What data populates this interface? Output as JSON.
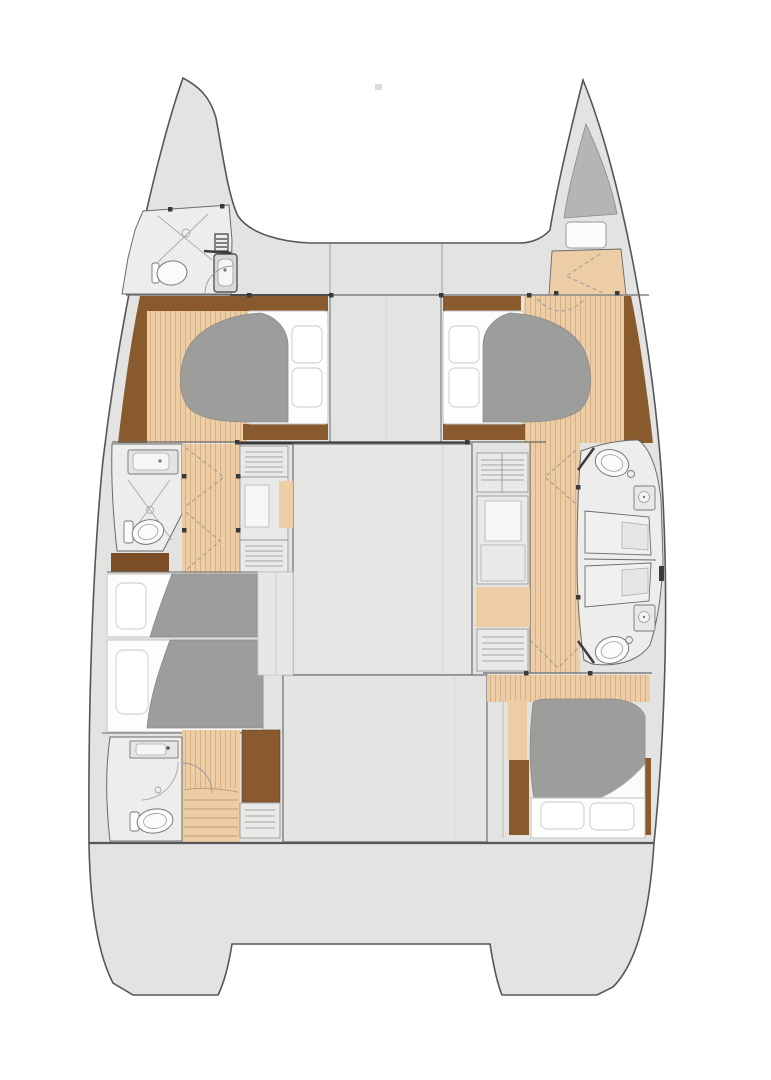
{
  "figure": {
    "type": "floorplan",
    "subject": "catamaran-interior-layout",
    "orientation": "bow-up",
    "hulls": 2,
    "visible_features": {
      "double_berth_cabins": 3,
      "single_berth_cabins": 2,
      "bathrooms": 4,
      "shower_stalls": 2,
      "bow_berth": 1,
      "transoms": 2
    }
  },
  "palette": {
    "background": "#ffffff",
    "deck": "#e3e3e2",
    "deck_line": "#55565a",
    "wall": "#6a6a6b",
    "dark": "#3a3a3b",
    "room": "#ededec",
    "cabinet": "#e9e9e8",
    "cabinet_line": "#8f8f90",
    "inset": "#f6f6f5",
    "wood": "#eccda5",
    "wood_line": "#d7b184",
    "wood_dark": "#8a5a2f",
    "wood_darker": "#7c4e28",
    "step_line": "#c49d72",
    "berth": "#b5b5b4",
    "duvet": "#9d9d9c",
    "duvet_line": "#8a8a89",
    "mattress": "#fdfdfc",
    "mattress_line": "#c4c4c3",
    "pillow_line": "#c9c9c8",
    "fixture": "#fbfbfa",
    "fixture_line": "#77787a",
    "seam": "#d6d6d5",
    "shower": "#f0f0ef",
    "bench": "#e6e6e5",
    "arc": "#9a9a9a"
  }
}
